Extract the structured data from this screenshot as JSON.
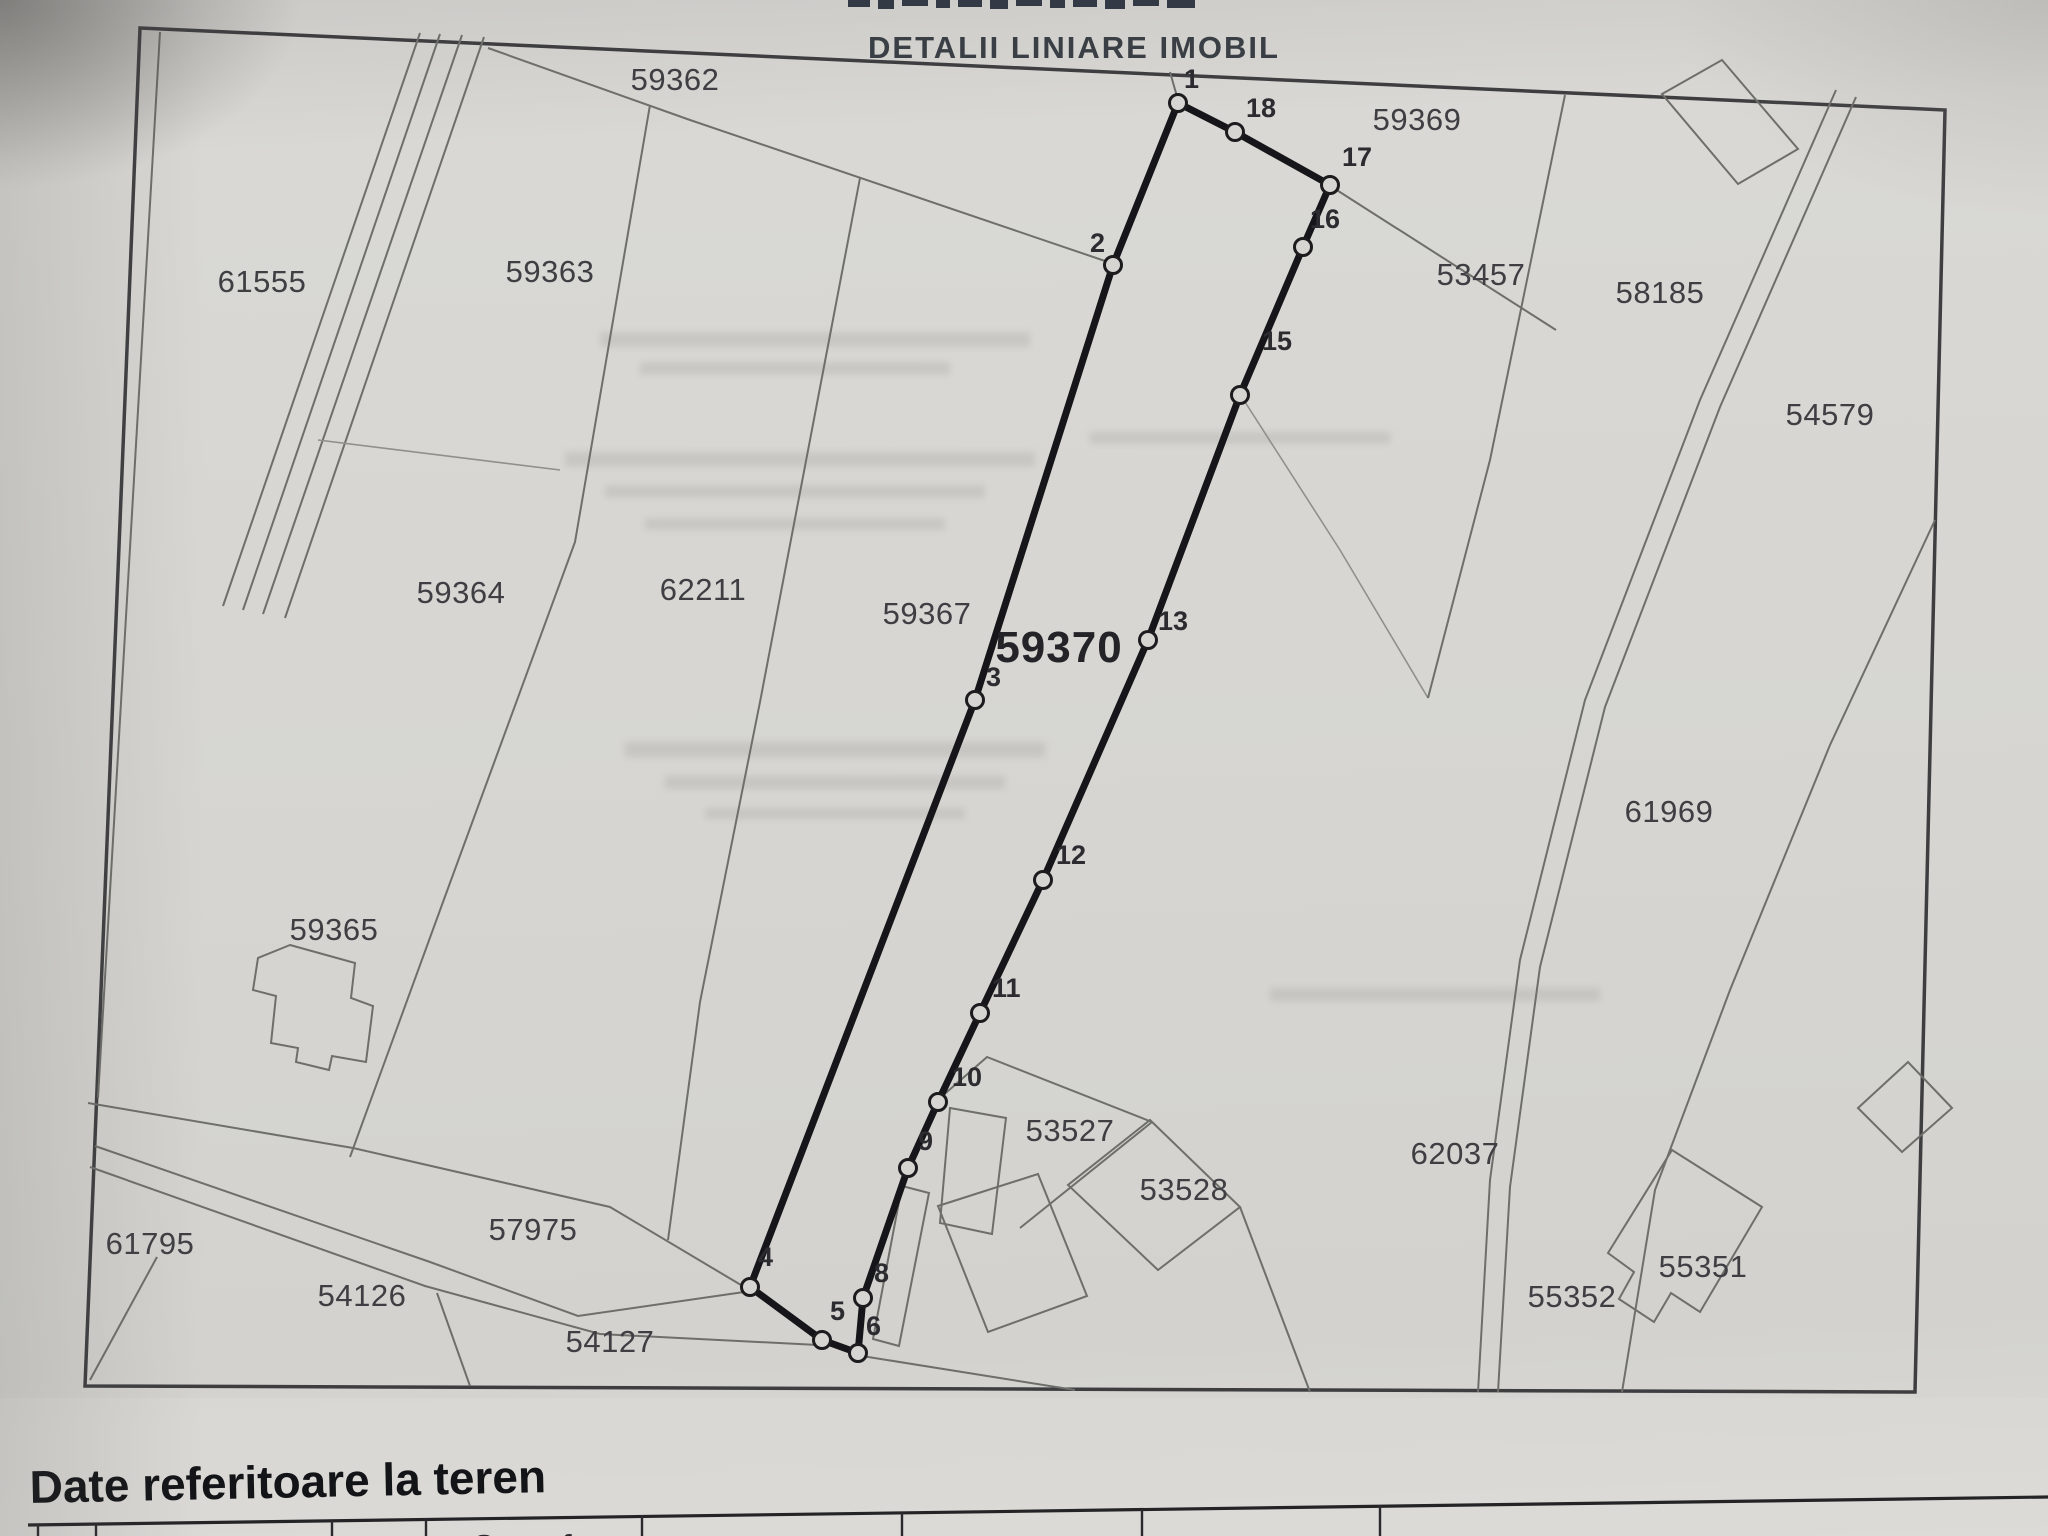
{
  "page": {
    "title": "DETALII LINIARE IMOBIL",
    "section_heading": "Date referitoare la teren"
  },
  "map": {
    "main_parcel_label": "59370",
    "parcels": [
      {
        "label": "59362",
        "x": 675,
        "y": 90
      },
      {
        "label": "59363",
        "x": 550,
        "y": 282
      },
      {
        "label": "61555",
        "x": 262,
        "y": 292
      },
      {
        "label": "59364",
        "x": 461,
        "y": 603
      },
      {
        "label": "62211",
        "x": 703,
        "y": 600
      },
      {
        "label": "59367",
        "x": 927,
        "y": 624
      },
      {
        "label": "59365",
        "x": 334,
        "y": 940
      },
      {
        "label": "59369",
        "x": 1417,
        "y": 130
      },
      {
        "label": "53457",
        "x": 1481,
        "y": 285
      },
      {
        "label": "58185",
        "x": 1660,
        "y": 303
      },
      {
        "label": "54579",
        "x": 1830,
        "y": 425
      },
      {
        "label": "61969",
        "x": 1669,
        "y": 822
      },
      {
        "label": "53527",
        "x": 1070,
        "y": 1141
      },
      {
        "label": "53528",
        "x": 1184,
        "y": 1200
      },
      {
        "label": "62037",
        "x": 1455,
        "y": 1164
      },
      {
        "label": "55352",
        "x": 1572,
        "y": 1307
      },
      {
        "label": "55351",
        "x": 1703,
        "y": 1277
      },
      {
        "label": "61795",
        "x": 150,
        "y": 1254
      },
      {
        "label": "54126",
        "x": 362,
        "y": 1306
      },
      {
        "label": "54127",
        "x": 610,
        "y": 1352
      },
      {
        "label": "57975",
        "x": 533,
        "y": 1240
      }
    ],
    "vertices": [
      {
        "n": "1",
        "x": 1178,
        "y": 103,
        "lx": 1184,
        "ly": 88
      },
      {
        "n": "2",
        "x": 1113,
        "y": 265,
        "lx": 1090,
        "ly": 252
      },
      {
        "n": "3",
        "x": 975,
        "y": 700,
        "lx": 986,
        "ly": 686
      },
      {
        "n": "4",
        "x": 750,
        "y": 1287,
        "lx": 758,
        "ly": 1266
      },
      {
        "n": "5",
        "x": 822,
        "y": 1340,
        "lx": 830,
        "ly": 1320
      },
      {
        "n": "6",
        "x": 858,
        "y": 1353,
        "lx": 866,
        "ly": 1335
      },
      {
        "n": "8",
        "x": 863,
        "y": 1298,
        "lx": 874,
        "ly": 1282
      },
      {
        "n": "9",
        "x": 908,
        "y": 1168,
        "lx": 918,
        "ly": 1150
      },
      {
        "n": "10",
        "x": 938,
        "y": 1102,
        "lx": 952,
        "ly": 1086
      },
      {
        "n": "11",
        "x": 980,
        "y": 1013,
        "lx": 992,
        "ly": 997
      },
      {
        "n": "12",
        "x": 1043,
        "y": 880,
        "lx": 1056,
        "ly": 864
      },
      {
        "n": "13",
        "x": 1148,
        "y": 640,
        "lx": 1158,
        "ly": 630
      },
      {
        "n": "15",
        "x": 1240,
        "y": 395,
        "lx": 1262,
        "ly": 350
      },
      {
        "n": "16",
        "x": 1303,
        "y": 247,
        "lx": 1310,
        "ly": 228
      },
      {
        "n": "17",
        "x": 1330,
        "y": 185,
        "lx": 1342,
        "ly": 166
      },
      {
        "n": "18",
        "x": 1235,
        "y": 132,
        "lx": 1246,
        "ly": 117
      }
    ]
  },
  "table": {
    "partial_header": "Suprafata"
  }
}
